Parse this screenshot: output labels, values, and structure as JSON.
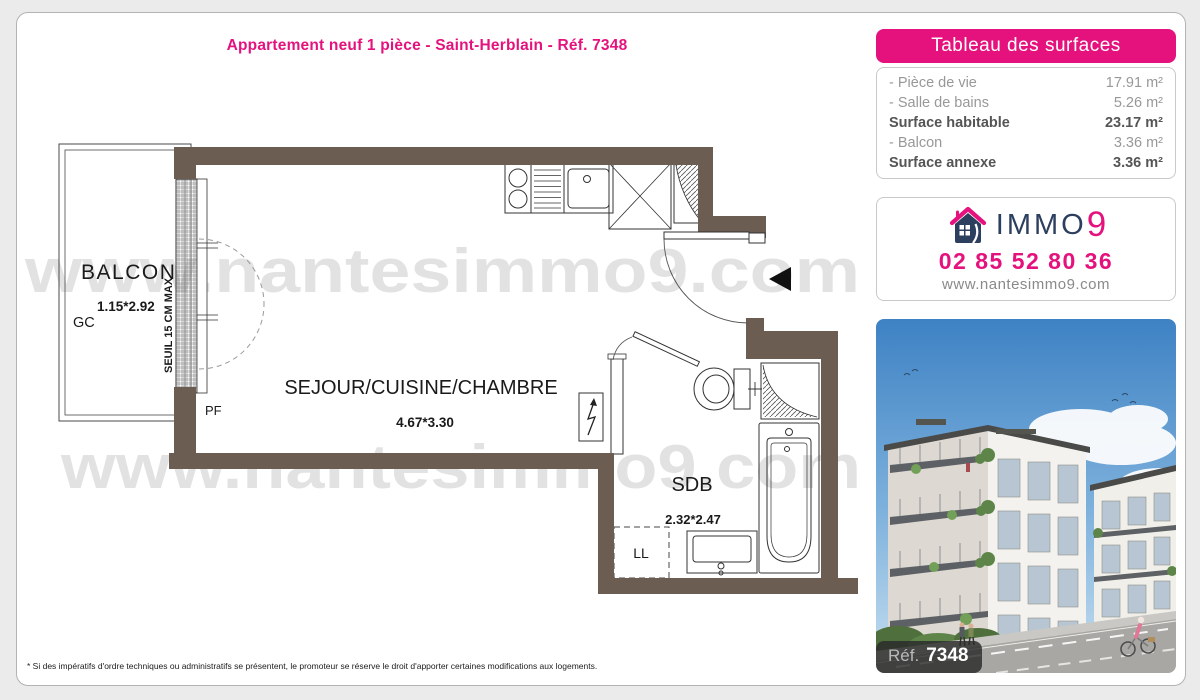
{
  "page": {
    "title": "Appartement neuf 1 pièce - Saint-Herblain - Réf. 7348",
    "footnote": "* Si des impératifs d'ordre techniques ou administratifs se présentent, le promoteur se réserve le droit d'apporter certaines modifications aux logements."
  },
  "surfaces": {
    "header": "Tableau des surfaces",
    "rows": [
      {
        "label": "- Pièce de vie",
        "value": "17.91 m²"
      },
      {
        "label": "- Salle de bains",
        "value": "5.26 m²"
      },
      {
        "label": "Surface habitable",
        "value": "23.17 m²"
      },
      {
        "label": "- Balcon",
        "value": "3.36 m²"
      },
      {
        "label": "Surface annexe",
        "value": "3.36 m²"
      }
    ]
  },
  "agency": {
    "brand": "IMMO",
    "brand_digit": "9",
    "phone": "02 85 52 80 36",
    "website": "www.nantesimmo9.com"
  },
  "photo": {
    "ref_label": "Réf.",
    "ref_number": "7348"
  },
  "plan": {
    "watermark": "www.nantesimmo9.com",
    "balcon_label": "BALCON",
    "balcon_dims": "1.15*2.92",
    "balcon_gc": "GC",
    "seuil_label": "SEUIL 15 CM MAX",
    "pf_label": "PF",
    "sejour_label": "SEJOUR/CUISINE/CHAMBRE",
    "sejour_dims": "4.67*3.30",
    "sdb_label": "SDB",
    "sdb_dims": "2.32*2.47",
    "ll_label": "LL"
  },
  "colors": {
    "accent": "#e5127d",
    "navy": "#2d3f5e",
    "wall": "#6b5d52"
  }
}
